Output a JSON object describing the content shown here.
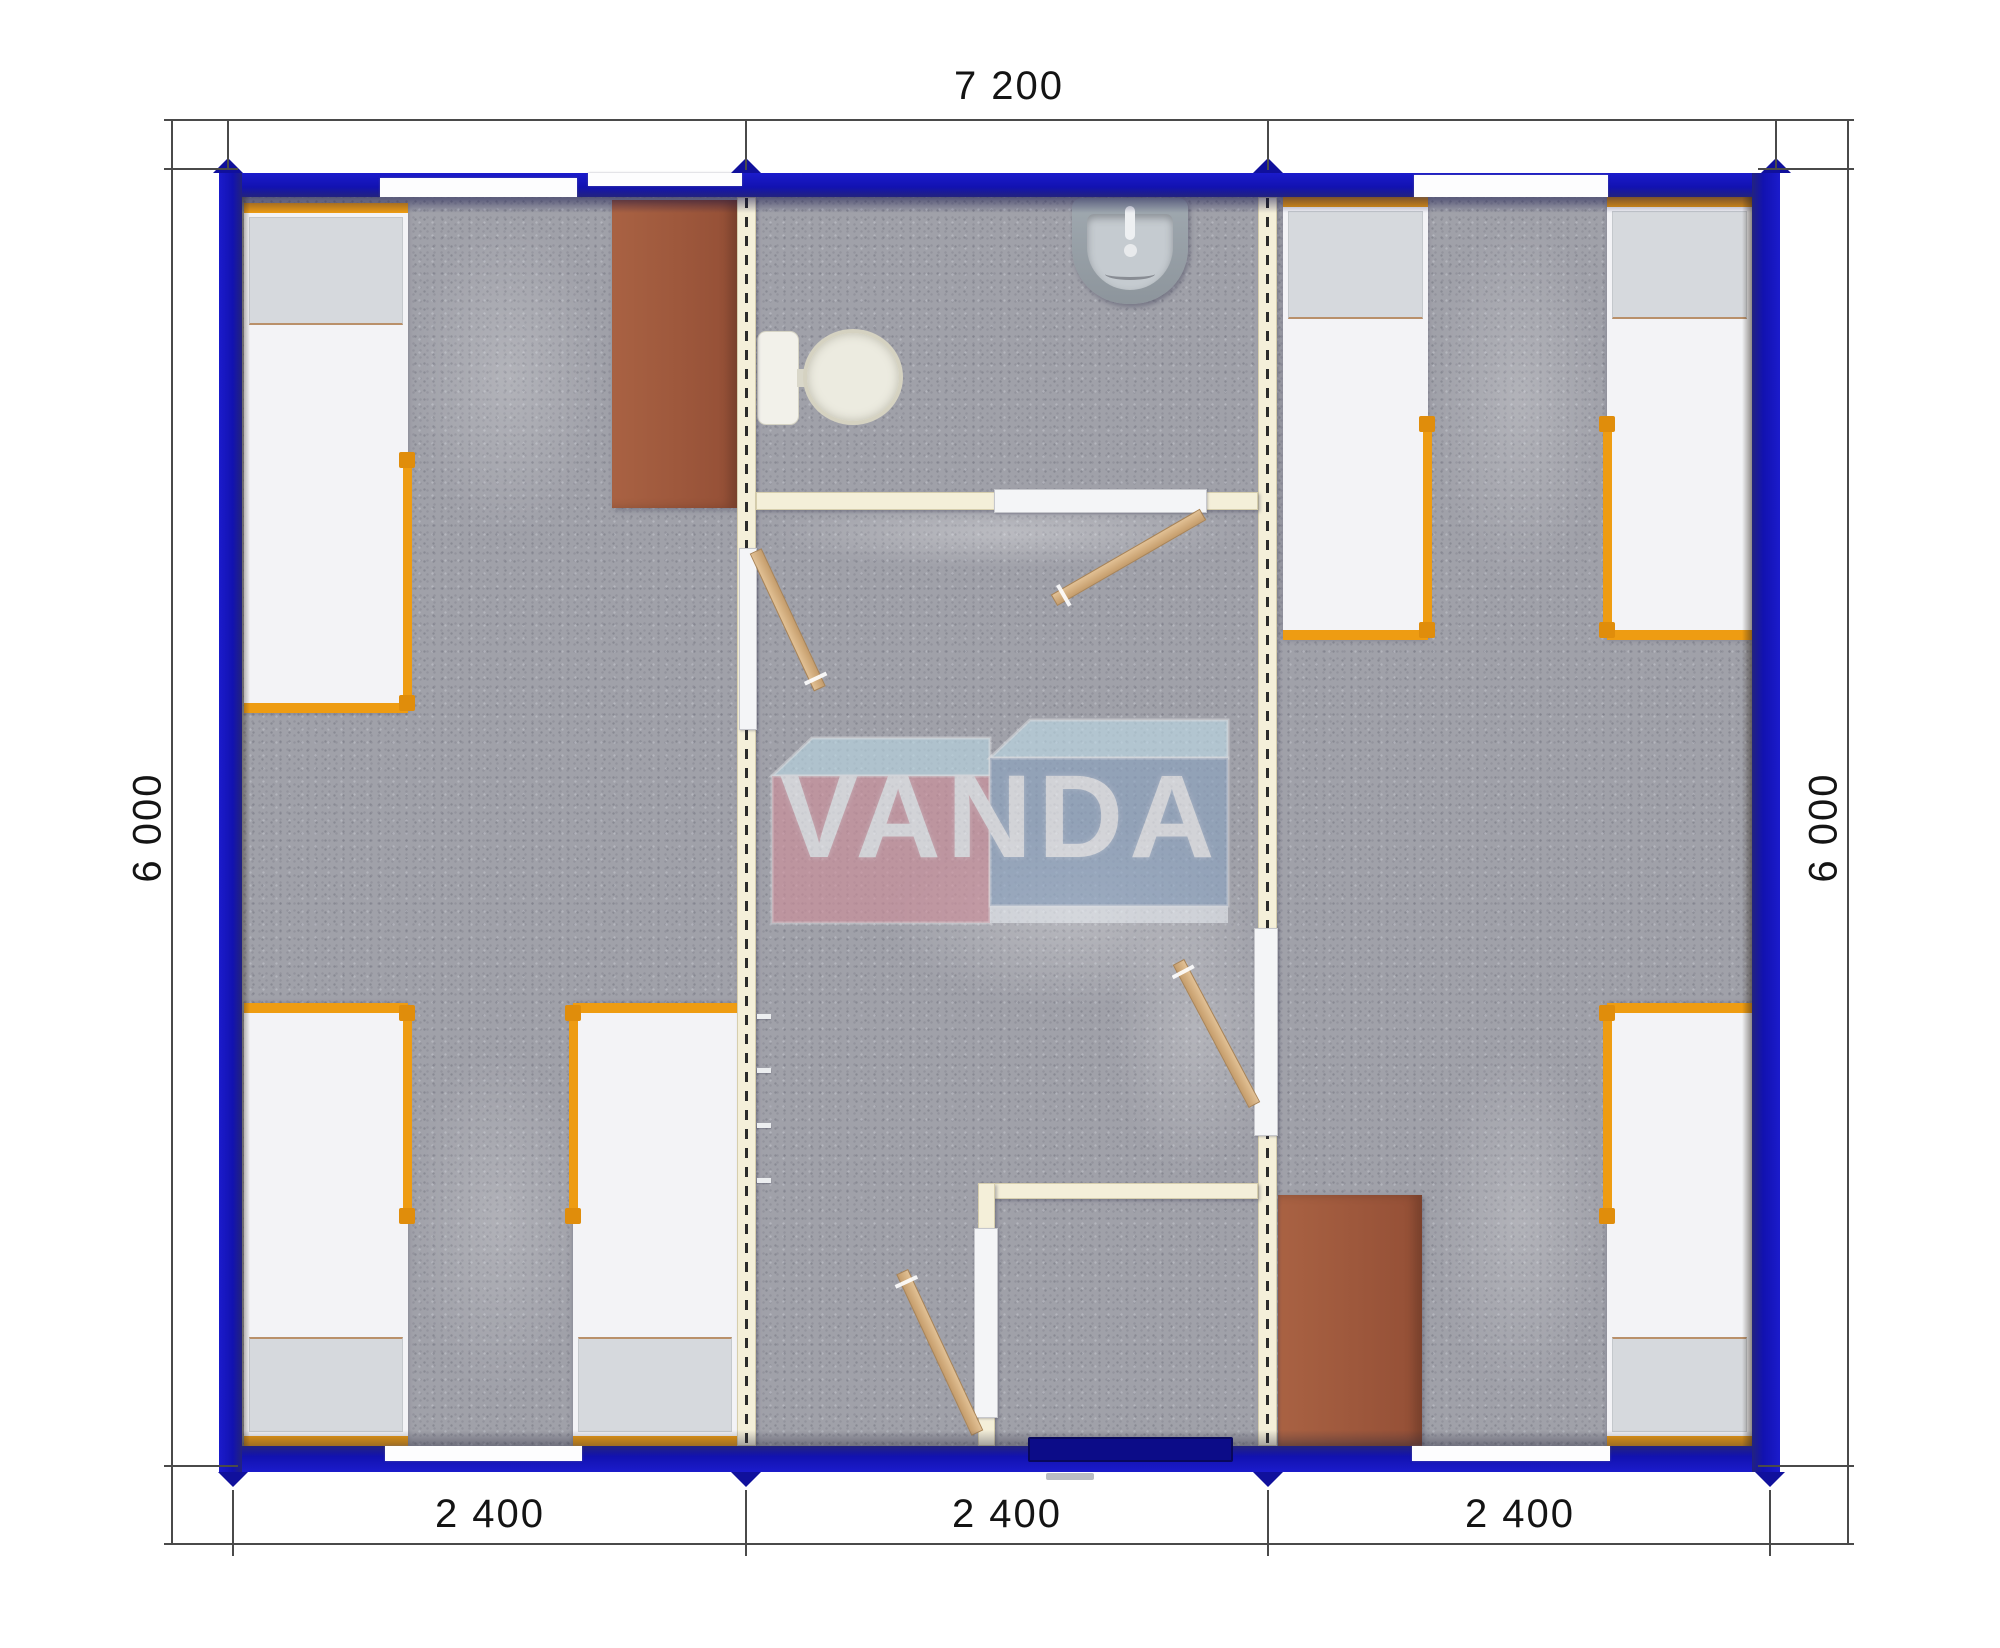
{
  "plan": {
    "type": "floor-plan",
    "brand": "VANDA",
    "overall_width_mm": "7 200",
    "overall_depth_mm": "6 000",
    "bays_mm": [
      "2 400",
      "2 400",
      "2 400"
    ]
  },
  "dimensions": {
    "top_total": "7 200",
    "left_side": "6 000",
    "right_side": "6 000",
    "bottom_segments": [
      "2 400",
      "2 400",
      "2 400"
    ]
  },
  "logo": {
    "text": "VANDA"
  },
  "colors": {
    "outer_wall_blue": "#1212b0",
    "partition_cream": "#f4efd9",
    "floor_carpet_gray": "#a0a1a9",
    "bed_frame_orange": "#ee9c12",
    "desk_brown": "#a05a3c",
    "door_leaf_wood": "#d4ab7c",
    "logo_pink": "#cf8e9a",
    "logo_blue": "#8ba3c1",
    "logo_top_face": "#b9d7e3"
  },
  "inventory": {
    "rooms": 3,
    "beds": 6,
    "desks": 2,
    "toilets": 1,
    "sinks": 1,
    "interior_door_leaves": 4,
    "sliding_door_panels": 4,
    "windows": 5,
    "entrance_doors": 1
  }
}
